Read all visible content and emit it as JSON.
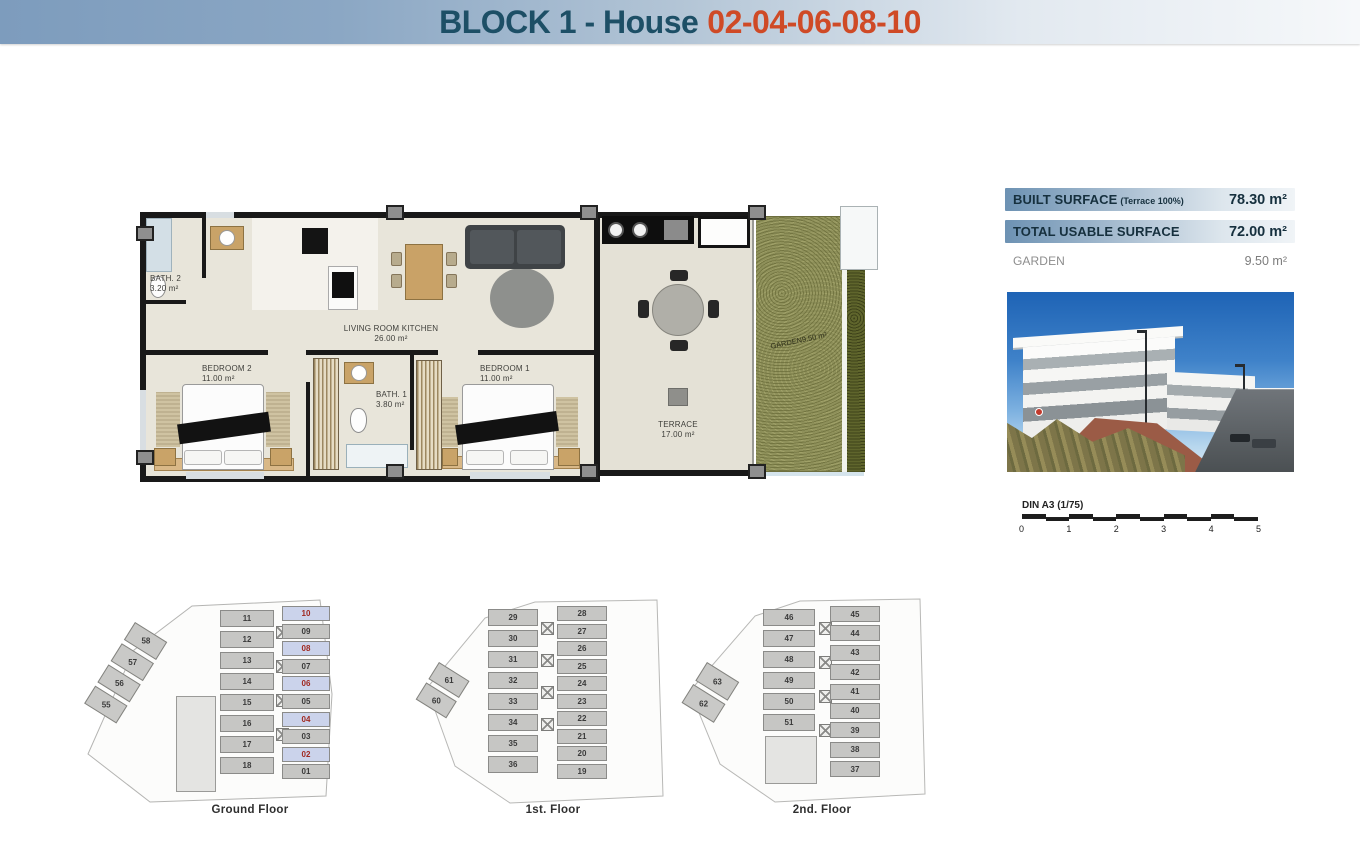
{
  "header": {
    "title_prefix": "BLOCK 1 - House",
    "title_numbers": "02-04-06-08-10"
  },
  "colors": {
    "title_teal": "#1d4f66",
    "title_orange": "#cf4a26",
    "surface_bar_blue": "#6d92b3",
    "highlight_cell": "#cbd3eb",
    "highlight_number": "#a02920",
    "garden_green": "#8e905a"
  },
  "floorplan": {
    "rooms": {
      "bath2": {
        "name": "BATH. 2",
        "area": "3.20 m²"
      },
      "living": {
        "name": "LIVING ROOM KITCHEN",
        "area": "26.00 m²"
      },
      "bedroom2": {
        "name": "BEDROOM 2",
        "area": "11.00 m²"
      },
      "bath1": {
        "name": "BATH. 1",
        "area": "3.80 m²"
      },
      "bedroom1": {
        "name": "BEDROOM 1",
        "area": "11.00 m²"
      },
      "terrace": {
        "name": "TERRACE",
        "area": "17.00 m²"
      },
      "garden": {
        "name": "GARDEN",
        "area": "9.50 m²"
      }
    }
  },
  "surfaces": [
    {
      "label": "BUILT SURFACE",
      "note": "(Terrace 100%)",
      "value": "78.30 m²",
      "hl": true
    },
    {
      "label": "TOTAL USABLE SURFACE",
      "note": "",
      "value": "72.00 m²",
      "hl": true
    },
    {
      "label": "GARDEN",
      "note": "",
      "value": "9.50 m²",
      "hl": false
    }
  ],
  "scalebar": {
    "label": "DIN A3 (1/75)",
    "ticks": [
      "0",
      "1",
      "2",
      "3",
      "4",
      "5"
    ]
  },
  "mini_plans": {
    "ground": {
      "label": "Ground Floor",
      "diagonal": [
        {
          "n": "58"
        },
        {
          "n": "57"
        },
        {
          "n": "56"
        },
        {
          "n": "55"
        }
      ],
      "left_column": [
        {
          "n": "11"
        },
        {
          "n": "12"
        },
        {
          "n": "13"
        },
        {
          "n": "14"
        },
        {
          "n": "15"
        },
        {
          "n": "16"
        },
        {
          "n": "17"
        },
        {
          "n": "18"
        }
      ],
      "right_column": [
        {
          "n": "10",
          "hl": true
        },
        {
          "n": "09"
        },
        {
          "n": "08",
          "hl": true
        },
        {
          "n": "07"
        },
        {
          "n": "06",
          "hl": true
        },
        {
          "n": "05"
        },
        {
          "n": "04",
          "hl": true
        },
        {
          "n": "03"
        },
        {
          "n": "02",
          "hl": true
        },
        {
          "n": "01"
        }
      ]
    },
    "first": {
      "label": "1st. Floor",
      "diagonal": [
        {
          "n": "61"
        },
        {
          "n": "60"
        }
      ],
      "left_column": [
        {
          "n": "29"
        },
        {
          "n": "30"
        },
        {
          "n": "31"
        },
        {
          "n": "32"
        },
        {
          "n": "33"
        },
        {
          "n": "34"
        },
        {
          "n": "35"
        },
        {
          "n": "36"
        }
      ],
      "right_column": [
        {
          "n": "28"
        },
        {
          "n": "27"
        },
        {
          "n": "26"
        },
        {
          "n": "25"
        },
        {
          "n": "24"
        },
        {
          "n": "23"
        },
        {
          "n": "22"
        },
        {
          "n": "21"
        },
        {
          "n": "20"
        },
        {
          "n": "19"
        }
      ]
    },
    "second": {
      "label": "2nd. Floor",
      "diagonal": [
        {
          "n": "63"
        },
        {
          "n": "62"
        }
      ],
      "left_column": [
        {
          "n": "46"
        },
        {
          "n": "47"
        },
        {
          "n": "48"
        },
        {
          "n": "49"
        },
        {
          "n": "50"
        },
        {
          "n": "51"
        }
      ],
      "right_column": [
        {
          "n": "45"
        },
        {
          "n": "44"
        },
        {
          "n": "43"
        },
        {
          "n": "42"
        },
        {
          "n": "41"
        },
        {
          "n": "40"
        },
        {
          "n": "39"
        },
        {
          "n": "38"
        },
        {
          "n": "37"
        }
      ]
    }
  }
}
